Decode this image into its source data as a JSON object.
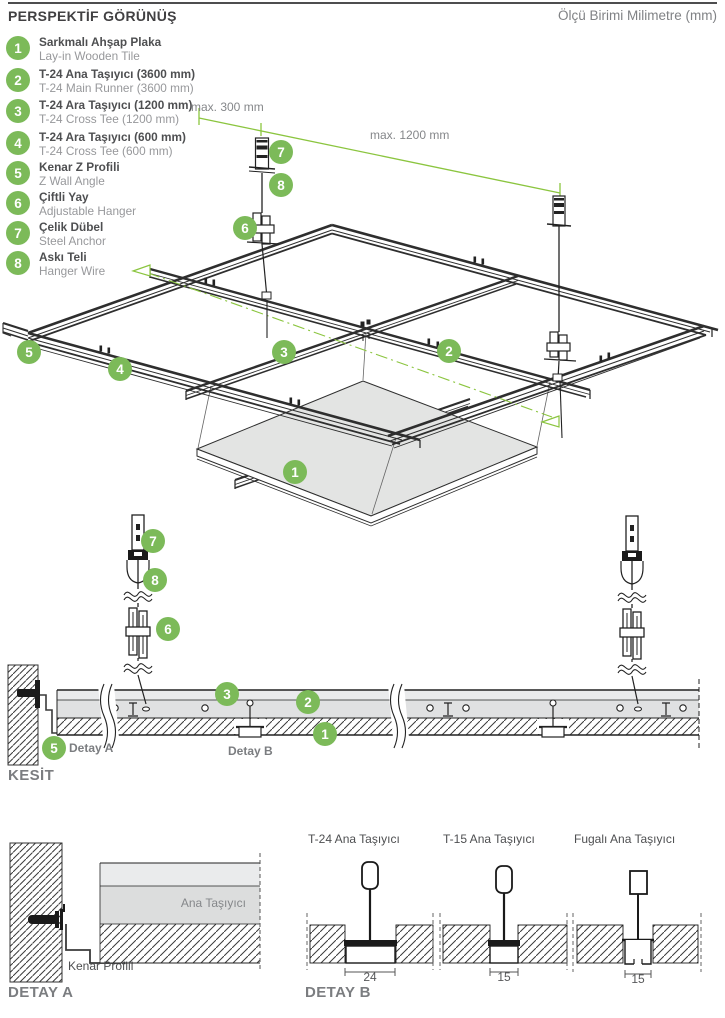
{
  "header": {
    "title": "PERSPEKTİF GÖRÜNÜŞ",
    "units": "Ölçü Birimi Milimetre (mm)"
  },
  "legend": {
    "items": [
      {
        "num": "1",
        "tr": "Sarkmalı Ahşap Plaka",
        "en": "Lay-in Wooden Tile"
      },
      {
        "num": "2",
        "tr": "T-24 Ana Taşıyıcı (3600 mm)",
        "en": "T-24 Main Runner (3600 mm)"
      },
      {
        "num": "3",
        "tr": "T-24 Ara Taşıyıcı (1200 mm)",
        "en": "T-24 Cross Tee (1200 mm)"
      },
      {
        "num": "4",
        "tr": "T-24 Ara Taşıyıcı (600 mm)",
        "en": "T-24 Cross Tee (600 mm)"
      },
      {
        "num": "5",
        "tr": "Kenar Z Profili",
        "en": "Z Wall Angle"
      },
      {
        "num": "6",
        "tr": "Çiftli Yay",
        "en": "Adjustable Hanger"
      },
      {
        "num": "7",
        "tr": "Çelik Dübel",
        "en": "Steel Anchor"
      },
      {
        "num": "8",
        "tr": "Askı Teli",
        "en": "Hanger Wire"
      }
    ]
  },
  "callouts": {
    "n1": "1",
    "n2": "2",
    "n3": "3",
    "n4": "4",
    "n5": "5",
    "n6": "6",
    "n7": "7",
    "n8": "8"
  },
  "perspective": {
    "dim_300": "max. 300 mm",
    "dim_1200": "max. 1200 mm"
  },
  "section": {
    "title": "KESİT",
    "detail_a_label": "Detay A",
    "detail_b_label": "Detay B"
  },
  "detail_a": {
    "title": "DETAY A",
    "main_runner_label": "Ana Taşıyıcı",
    "edge_profile_label": "Kenar Profili"
  },
  "detail_b": {
    "title": "DETAY B",
    "profiles": [
      {
        "name": "T-24 Ana Taşıyıcı",
        "dim": "24"
      },
      {
        "name": "T-15 Ana Taşıyıcı",
        "dim": "15"
      },
      {
        "name": "Fugalı Ana Taşıyıcı",
        "dim": "15"
      }
    ]
  },
  "colors": {
    "accent_green": "#7cba59",
    "line_green": "#8bc53f",
    "text_dark": "#4e4f51",
    "text_gray": "#808285",
    "text_light": "#97989b",
    "tile_fill": "#e3e4e3",
    "band_fill": "#e0e1e2",
    "line": "#2e2e2e"
  }
}
